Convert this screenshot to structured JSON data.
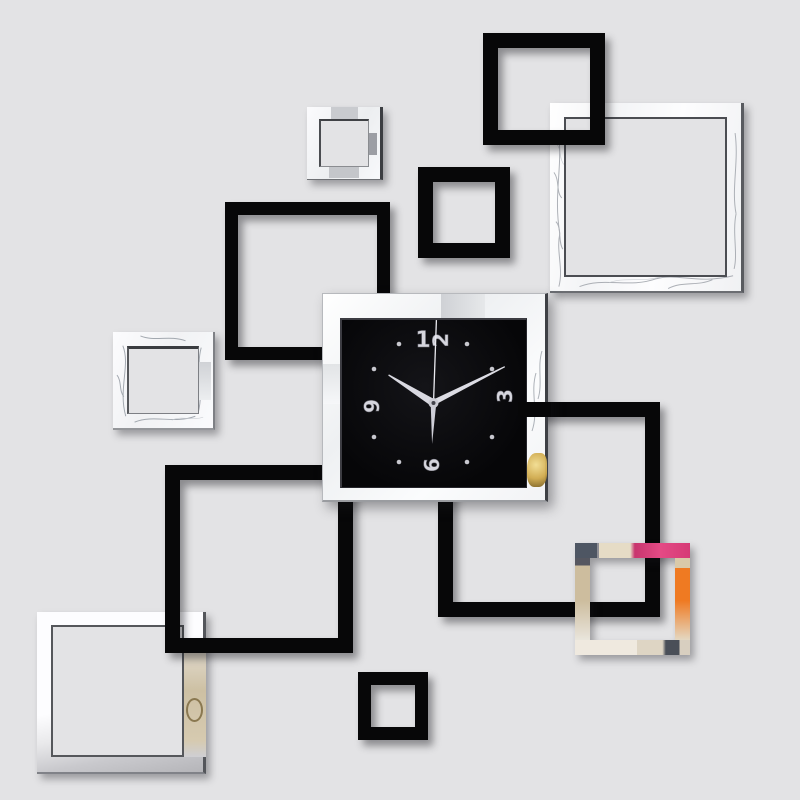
{
  "scene": {
    "title": "DIY 3D acrylic mirror wall clock sticker set with overlapping black and silver square frames on a light gray wall",
    "wall_color": "#e3e3e5",
    "clock": {
      "time": "10:09",
      "numerals": {
        "top": "12",
        "right": "3",
        "bottom": "6",
        "left": "9"
      },
      "numeral_style": "silver embossed digits lying sideways",
      "face_color": "#08080a",
      "frame_color": "#f7f8fa",
      "hands_color": "#d9d9e1",
      "second_hand_color": "#eaeaf0",
      "marker_dot_color": "#c7c7ce",
      "gold_ornament_color": "#d4b35e"
    },
    "frames": {
      "black_frame_color": "#070708",
      "mirror_frame_color": "#f6f7f9",
      "mirror_edge_color": "#54565b",
      "black_frames_count": 6,
      "mirror_frames_count": 5,
      "reflection_colors": {
        "branch_gray": "#9fa3aa",
        "dark_slate": "#4e5660",
        "pink": "#d23b76",
        "orange": "#ee7522",
        "beige": "#cdc0a3",
        "cream": "#e9e2d2",
        "gold_ring": "#8a7850"
      }
    }
  }
}
